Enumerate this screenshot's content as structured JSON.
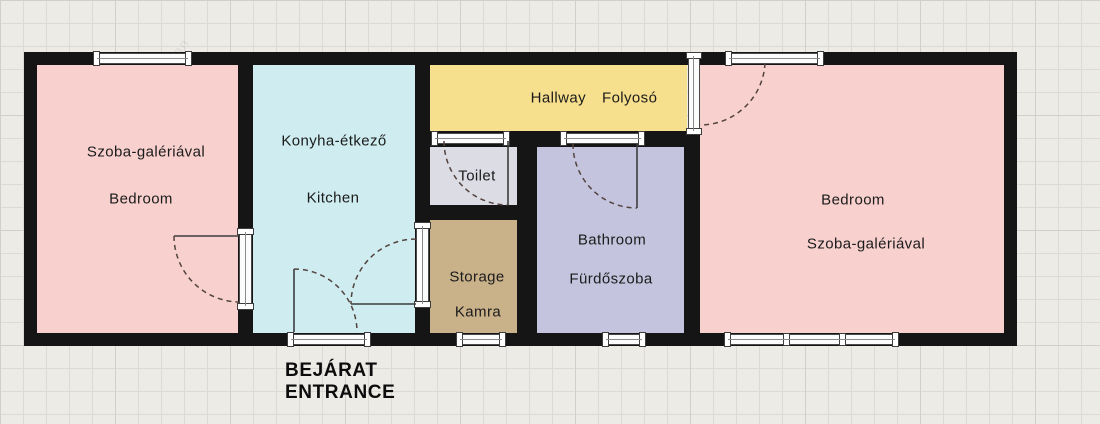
{
  "plan": {
    "rooms": {
      "bedroom_left": {
        "label_hu": "Szoba-galériával",
        "label_en": "Bedroom",
        "color": "#f8d1cf"
      },
      "kitchen": {
        "label_hu": "Konyha-étkező",
        "label_en": "Kitchen",
        "color": "#cfedf0"
      },
      "hallway": {
        "label_en": "Hallway",
        "label_hu": "Folyosó",
        "color": "#f6df8d"
      },
      "toilet": {
        "label_en": "Toilet",
        "color": "#dcdce4"
      },
      "storage": {
        "label_en": "Storage",
        "label_hu": "Kamra",
        "color": "#c9b189"
      },
      "bathroom": {
        "label_en": "Bathroom",
        "label_hu": "Fürdőszoba",
        "color": "#c5c4de"
      },
      "bedroom_right": {
        "label_en": "Bedroom",
        "label_hu": "Szoba-galériával",
        "color": "#f8d1cf"
      }
    },
    "entrance": {
      "label_hu": "BEJÁRAT",
      "label_en": "ENTRANCE"
    },
    "watermark": "ingatlan",
    "colors": {
      "wall": "#151515",
      "background": "#edebe6",
      "grid_line": "#dddad5",
      "window_fill": "#fcfcfc",
      "frame_line": "#4a4a4a"
    }
  }
}
